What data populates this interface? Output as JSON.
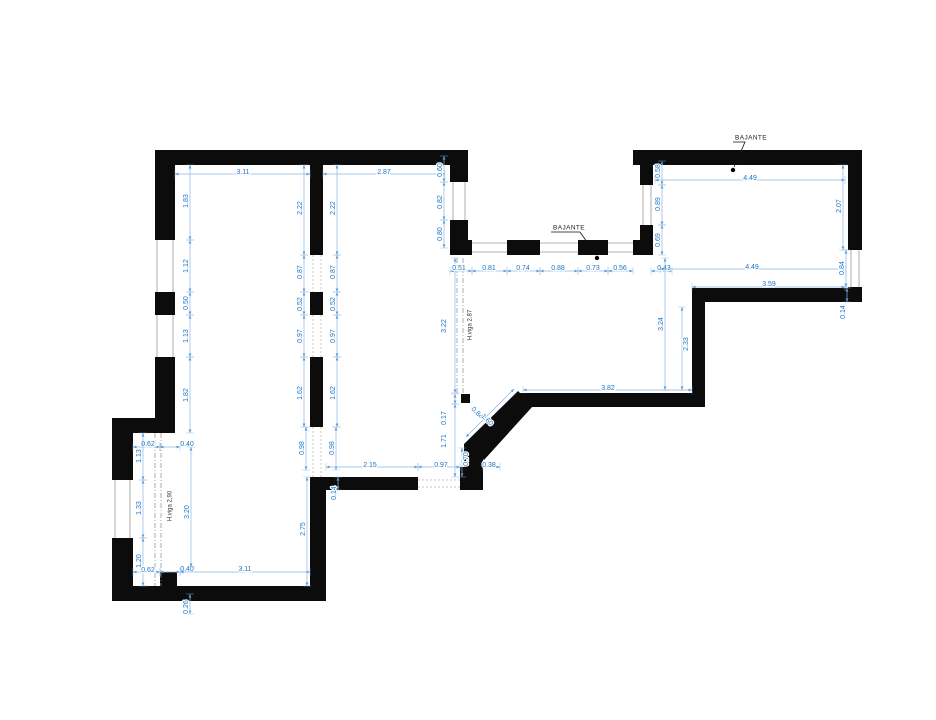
{
  "colors": {
    "wall": "#0c0c0c",
    "dimension_text": "#1c76c8",
    "dimension_line": "#8ab6e4",
    "window_line": "#9a9a9a",
    "beam_line": "#8a8a8a",
    "annotation_text": "#1a1a1a"
  },
  "annotations": {
    "downpipe_labels": [
      {
        "text": "BAJANTE",
        "x": 751,
        "y": 138,
        "leader": [
          745,
          144,
          734,
          167
        ],
        "dot": [
          733,
          170
        ]
      },
      {
        "text": "BAJANTE",
        "x": 569,
        "y": 228,
        "leader": [
          580,
          234,
          596,
          255
        ],
        "dot": [
          597,
          258
        ]
      }
    ],
    "beam_labels": [
      {
        "text": "H.viga 2.87",
        "x": 470,
        "y": 325,
        "rot": -90
      },
      {
        "text": "H.viga 2,90",
        "x": 170,
        "y": 506,
        "rot": -90
      }
    ]
  },
  "dimensions": [
    {
      "t": "3.11",
      "x": 243,
      "y": 172,
      "r": 0,
      "l": [
        175,
        174,
        310,
        174
      ]
    },
    {
      "t": "2.87",
      "x": 384,
      "y": 172,
      "r": 0,
      "l": [
        323,
        174,
        445,
        174
      ]
    },
    {
      "t": "0.60",
      "x": 440,
      "y": 170,
      "r": -90,
      "l": [
        444,
        156,
        444,
        182
      ]
    },
    {
      "t": "0.82",
      "x": 440,
      "y": 202,
      "r": -90,
      "l": [
        444,
        182,
        444,
        220
      ]
    },
    {
      "t": "0.80",
      "x": 440,
      "y": 234,
      "r": -90,
      "l": [
        444,
        220,
        444,
        248
      ]
    },
    {
      "t": "1.83",
      "x": 186,
      "y": 201,
      "r": -90,
      "l": [
        190,
        165,
        190,
        240
      ]
    },
    {
      "t": "1.12",
      "x": 186,
      "y": 266,
      "r": -90,
      "l": [
        190,
        240,
        190,
        292
      ]
    },
    {
      "t": "0.50",
      "x": 186,
      "y": 303,
      "r": -90,
      "l": [
        190,
        292,
        190,
        315
      ]
    },
    {
      "t": "1.13",
      "x": 186,
      "y": 336,
      "r": -90,
      "l": [
        190,
        315,
        190,
        357
      ]
    },
    {
      "t": "1.82",
      "x": 186,
      "y": 395,
      "r": -90,
      "l": [
        190,
        357,
        190,
        433
      ]
    },
    {
      "t": "2.22",
      "x": 300,
      "y": 208,
      "r": -90,
      "l": [
        304,
        165,
        304,
        255
      ]
    },
    {
      "t": "2.22",
      "x": 333,
      "y": 208,
      "r": -90,
      "l": [
        337,
        165,
        337,
        255
      ]
    },
    {
      "t": "0.87",
      "x": 300,
      "y": 272,
      "r": -90,
      "l": [
        304,
        255,
        304,
        292
      ]
    },
    {
      "t": "0.87",
      "x": 333,
      "y": 272,
      "r": -90,
      "l": [
        337,
        255,
        337,
        292
      ]
    },
    {
      "t": "0.52",
      "x": 300,
      "y": 304,
      "r": -90,
      "l": [
        304,
        292,
        304,
        315
      ]
    },
    {
      "t": "0.52",
      "x": 333,
      "y": 304,
      "r": -90,
      "l": [
        337,
        292,
        337,
        315
      ]
    },
    {
      "t": "0.97",
      "x": 300,
      "y": 336,
      "r": -90,
      "l": [
        304,
        315,
        304,
        357
      ]
    },
    {
      "t": "0.97",
      "x": 333,
      "y": 336,
      "r": -90,
      "l": [
        337,
        315,
        337,
        357
      ]
    },
    {
      "t": "1.62",
      "x": 300,
      "y": 393,
      "r": -90,
      "l": [
        304,
        357,
        304,
        427
      ]
    },
    {
      "t": "1.62",
      "x": 333,
      "y": 393,
      "r": -90,
      "l": [
        337,
        357,
        337,
        427
      ]
    },
    {
      "t": "0.98",
      "x": 302,
      "y": 448,
      "r": -90,
      "l": [
        306,
        427,
        306,
        470
      ]
    },
    {
      "t": "0.98",
      "x": 332,
      "y": 448,
      "r": -90,
      "l": [
        336,
        427,
        336,
        470
      ]
    },
    {
      "t": "0.62",
      "x": 148,
      "y": 444,
      "r": 0,
      "l": [
        133,
        447,
        160,
        447
      ]
    },
    {
      "t": "0.40",
      "x": 187,
      "y": 444,
      "r": 0,
      "l": [
        160,
        447,
        180,
        447
      ]
    },
    {
      "t": "1.13",
      "x": 139,
      "y": 456,
      "r": -90,
      "l": [
        143,
        433,
        143,
        480
      ]
    },
    {
      "t": "1.33",
      "x": 139,
      "y": 508,
      "r": -90,
      "l": [
        143,
        480,
        143,
        538
      ]
    },
    {
      "t": "1.20",
      "x": 139,
      "y": 561,
      "r": -90,
      "l": [
        143,
        538,
        143,
        586
      ]
    },
    {
      "t": "0.62",
      "x": 148,
      "y": 570,
      "r": 0,
      "l": [
        133,
        572,
        160,
        572
      ]
    },
    {
      "t": "0.40",
      "x": 187,
      "y": 569,
      "r": 0,
      "l": [
        160,
        572,
        180,
        572
      ]
    },
    {
      "t": "3.11",
      "x": 245,
      "y": 569,
      "r": 0,
      "l": [
        180,
        572,
        310,
        572
      ]
    },
    {
      "t": "3.20",
      "x": 187,
      "y": 512,
      "r": -90,
      "l": [
        191,
        447,
        191,
        567
      ]
    },
    {
      "t": "0.26",
      "x": 186,
      "y": 607,
      "r": -90,
      "l": [
        190,
        594,
        190,
        614
      ]
    },
    {
      "t": "2.75",
      "x": 303,
      "y": 529,
      "r": -90,
      "l": [
        307,
        477,
        307,
        586
      ]
    },
    {
      "t": "0.14",
      "x": 334,
      "y": 493,
      "r": -90,
      "l": [
        338,
        477,
        338,
        490
      ]
    },
    {
      "t": "3.22",
      "x": 444,
      "y": 326,
      "r": -90,
      "l": [
        455,
        258,
        455,
        393
      ]
    },
    {
      "t": "0.17",
      "x": 444,
      "y": 418,
      "r": -90,
      "l": [
        455,
        394,
        455,
        404
      ]
    },
    {
      "t": "1.71",
      "x": 444,
      "y": 441,
      "r": -90,
      "l": [
        455,
        404,
        455,
        477
      ]
    },
    {
      "t": "2.15",
      "x": 370,
      "y": 465,
      "r": 0,
      "l": [
        326,
        467,
        418,
        467
      ]
    },
    {
      "t": "0.97",
      "x": 441,
      "y": 465,
      "r": 0,
      "l": [
        418,
        467,
        460,
        467
      ]
    },
    {
      "t": "0.70",
      "x": 466,
      "y": 459,
      "r": -90,
      "l": [
        462,
        448,
        462,
        477
      ]
    },
    {
      "t": "0.38",
      "x": 489,
      "y": 465,
      "r": 0,
      "l": [
        483,
        467,
        500,
        467
      ]
    },
    {
      "t": "0.84",
      "x": 477,
      "y": 413,
      "r": 45,
      "l": [
        466,
        437,
        514,
        389
      ]
    },
    {
      "t": "1.60",
      "x": 487,
      "y": 420,
      "r": 45
    },
    {
      "t": "0.51",
      "x": 459,
      "y": 268,
      "r": 0,
      "l": [
        450,
        271,
        472,
        271
      ]
    },
    {
      "t": "0.81",
      "x": 489,
      "y": 268,
      "r": 0,
      "l": [
        472,
        271,
        507,
        271
      ]
    },
    {
      "t": "0.74",
      "x": 523,
      "y": 268,
      "r": 0,
      "l": [
        507,
        271,
        540,
        271
      ]
    },
    {
      "t": "0.88",
      "x": 558,
      "y": 268,
      "r": 0,
      "l": [
        540,
        271,
        578,
        271
      ]
    },
    {
      "t": "0.73",
      "x": 593,
      "y": 268,
      "r": 0,
      "l": [
        578,
        271,
        608,
        271
      ]
    },
    {
      "t": "0.56",
      "x": 620,
      "y": 268,
      "r": 0,
      "l": [
        608,
        271,
        633,
        271
      ]
    },
    {
      "t": "0.43",
      "x": 664,
      "y": 268,
      "r": 0,
      "l": [
        651,
        271,
        672,
        271
      ]
    },
    {
      "t": "0.58",
      "x": 658,
      "y": 171,
      "r": -90,
      "l": [
        662,
        161,
        662,
        185
      ]
    },
    {
      "t": "0.89",
      "x": 658,
      "y": 204,
      "r": -90,
      "l": [
        662,
        185,
        662,
        225
      ]
    },
    {
      "t": "0.69",
      "x": 658,
      "y": 240,
      "r": -90,
      "l": [
        662,
        225,
        662,
        255
      ]
    },
    {
      "t": "3.24",
      "x": 661,
      "y": 324,
      "r": -90,
      "l": [
        665,
        258,
        665,
        390
      ]
    },
    {
      "t": "2.33",
      "x": 686,
      "y": 344,
      "r": -90,
      "l": [
        682,
        307,
        682,
        390
      ]
    },
    {
      "t": "3.82",
      "x": 608,
      "y": 388,
      "r": 0,
      "l": [
        523,
        390,
        692,
        390
      ]
    },
    {
      "t": "4.49",
      "x": 750,
      "y": 178,
      "r": 0,
      "l": [
        655,
        180,
        845,
        180
      ]
    },
    {
      "t": "2.07",
      "x": 839,
      "y": 206,
      "r": -90,
      "l": [
        843,
        165,
        843,
        250
      ]
    },
    {
      "t": "4.49",
      "x": 752,
      "y": 267,
      "r": 0,
      "l": [
        660,
        269,
        845,
        269
      ]
    },
    {
      "t": "0.84",
      "x": 842,
      "y": 268,
      "r": -90,
      "l": [
        846,
        250,
        846,
        287
      ]
    },
    {
      "t": "3.59",
      "x": 769,
      "y": 284,
      "r": 0,
      "l": [
        692,
        287,
        845,
        287
      ]
    },
    {
      "t": "0.14",
      "x": 843,
      "y": 312,
      "r": -90,
      "l": [
        847,
        288,
        847,
        302
      ]
    }
  ]
}
